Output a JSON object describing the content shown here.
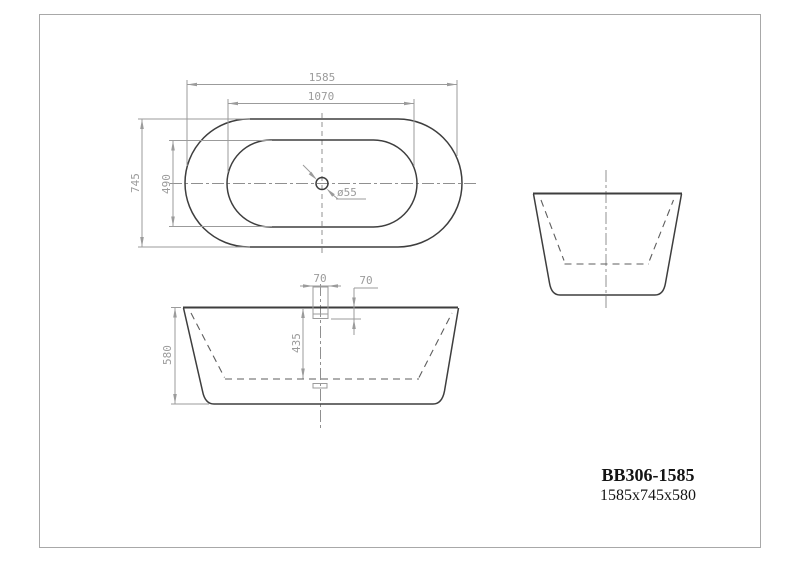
{
  "title_block": {
    "model": "BB306-1585",
    "overall_size": "1585x745x580"
  },
  "top_view": {
    "dims": {
      "length": "1585",
      "rim_length": "1070",
      "width": "745",
      "rim_width": "490",
      "drain_diameter": "ø55"
    }
  },
  "front_view": {
    "dims": {
      "overflow_width": "70",
      "overflow_drop": "70",
      "inner_depth": "435",
      "height": "580"
    }
  },
  "colors": {
    "background": "#ffffff",
    "outline": "#3e3e3e",
    "dash": "#5e5e5e",
    "dim": "#9b9b9b",
    "center": "#909090",
    "frame": "#a8a8a8",
    "title": "#141414"
  }
}
